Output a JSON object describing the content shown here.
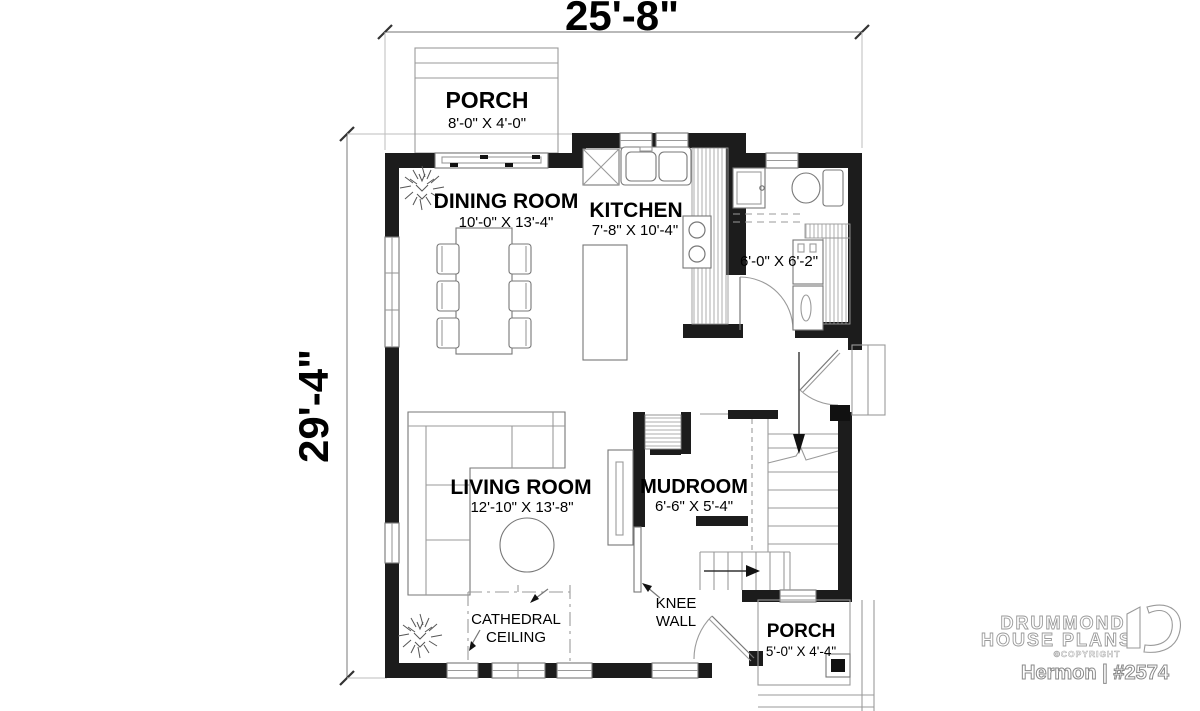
{
  "dimensions": {
    "width_label": "25'-8\"",
    "height_label": "29'-4\""
  },
  "rooms": {
    "porch_top": {
      "name": "PORCH",
      "size": "8'-0\" X 4'-0\""
    },
    "dining_room": {
      "name": "DINING ROOM",
      "size": "10'-0\" X 13'-4\""
    },
    "kitchen": {
      "name": "KITCHEN",
      "size": "7'-8\" X 10'-4\""
    },
    "laundry_bath": {
      "size": "6'-0\" X 6'-2\""
    },
    "living_room": {
      "name": "LIVING ROOM",
      "size": "12'-10\" X 13'-8\""
    },
    "mudroom": {
      "name": "MUDROOM",
      "size": "6'-6\" X 5'-4\""
    },
    "porch_bottom": {
      "name": "PORCH",
      "size": "5'-0\" X 4'-4\""
    }
  },
  "annotations": {
    "cathedral_line1": "CATHEDRAL",
    "cathedral_line2": "CEILING",
    "knee_line1": "KNEE",
    "knee_line2": "WALL"
  },
  "branding": {
    "company_line1": "DRUMMOND",
    "company_line2": "HOUSE PLANS",
    "copyright": "©COPYRIGHT",
    "plan_name": "Hermon | #2574"
  },
  "colors": {
    "wall": "#1c1c1c",
    "line": "#8a8a8a",
    "text": "#000000",
    "background": "#ffffff"
  }
}
